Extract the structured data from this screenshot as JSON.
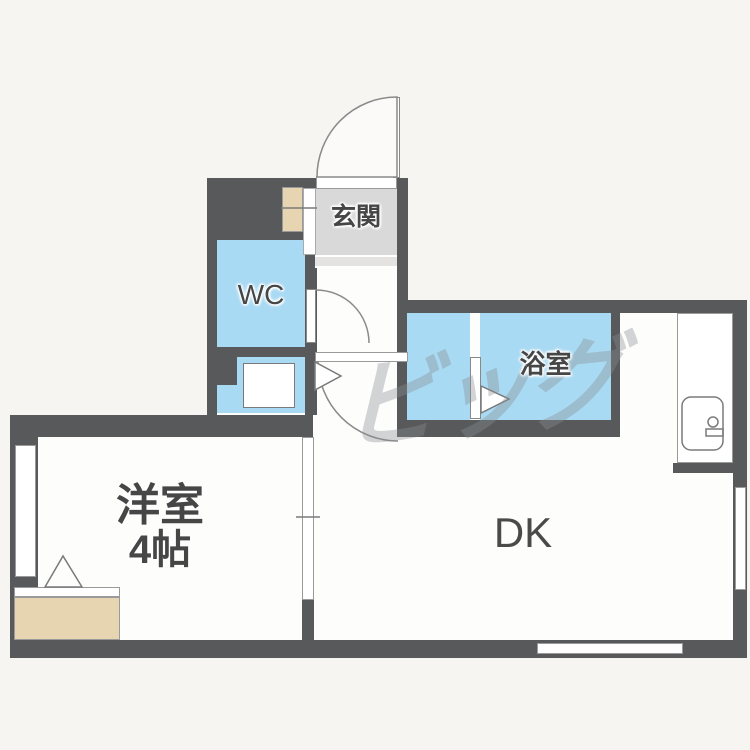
{
  "plan_title": "1DK floor plan",
  "rooms": {
    "genkan": {
      "label": "玄関"
    },
    "wc": {
      "label": "WC"
    },
    "bath": {
      "label": "浴室"
    },
    "western_room": {
      "label": "洋室",
      "size_label": "4帖"
    },
    "dk": {
      "label": "DK"
    }
  },
  "watermark": {
    "text": "ビッグ"
  },
  "colors": {
    "wall": "#58595b",
    "water": "#a9daf3",
    "tan": "#e7d4b0",
    "genkan": "#d9d9d9",
    "paper": "#f7f5f1",
    "floor": "#fdfdfc",
    "label": "#464646"
  }
}
